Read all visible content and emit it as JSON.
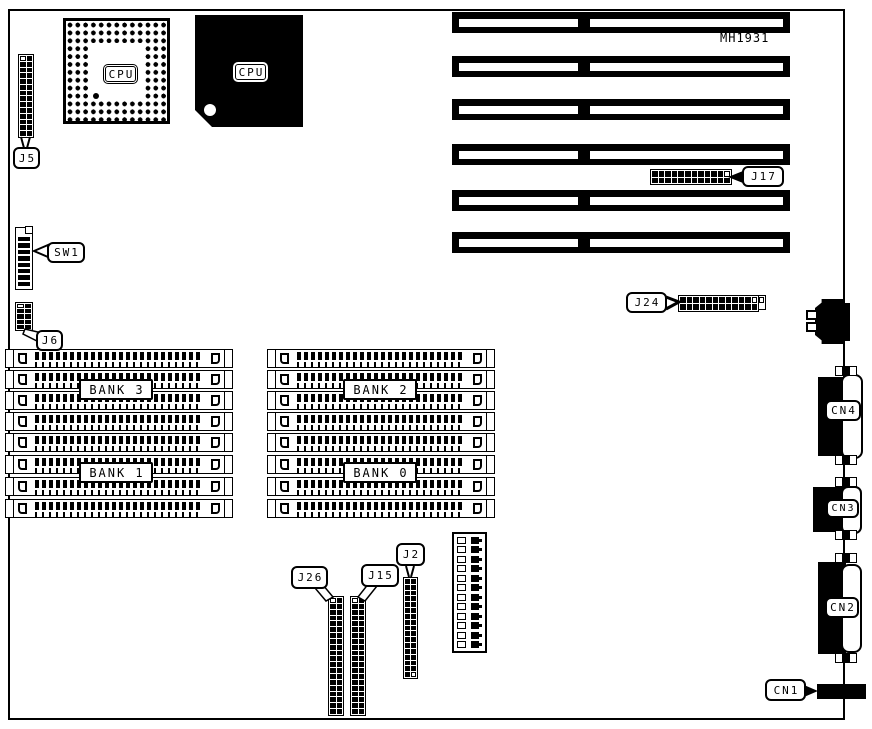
{
  "board": {
    "part_number": "MH1931"
  },
  "cpu": {
    "socket_label": "CPU",
    "chip_label": "CPU"
  },
  "labels": {
    "j5": "J5",
    "sw1": "SW1",
    "j6": "J6",
    "j17": "J17",
    "j24": "J24",
    "j26": "J26",
    "j15": "J15",
    "j2": "J2",
    "cn1": "CN1",
    "cn2": "CN2",
    "cn3": "CN3",
    "cn4": "CN4"
  },
  "memory": {
    "slots_per_bank": 4,
    "banks": [
      {
        "label": "BANK 3"
      },
      {
        "label": "BANK 2"
      },
      {
        "label": "BANK 1"
      },
      {
        "label": "BANK 0"
      }
    ]
  },
  "expansion_slots": {
    "count": 6
  }
}
